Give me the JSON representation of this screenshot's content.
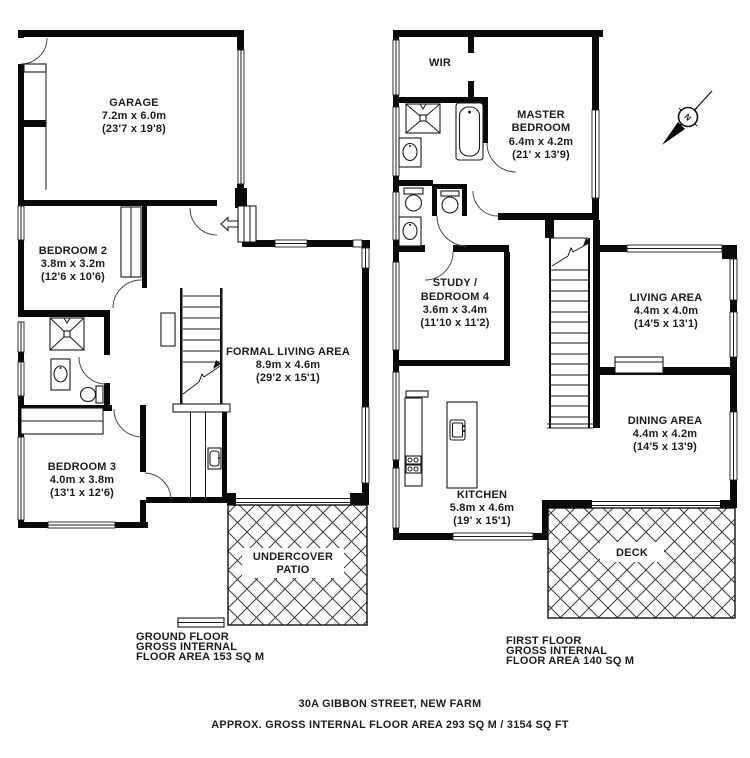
{
  "meta": {
    "address": "30A GIBBON STREET, NEW FARM",
    "area_summary": "APPROX. GROSS INTERNAL FLOOR AREA 293 SQ M / 3154 SQ FT"
  },
  "compass": {
    "north_label": "N"
  },
  "ground_floor": {
    "summary_lines": [
      "GROUND FLOOR",
      "GROSS INTERNAL",
      "FLOOR AREA 153 SQ M"
    ],
    "rooms": {
      "garage": {
        "lines": [
          "GARAGE",
          "7.2m x 6.0m",
          "(23'7 x 19'8)"
        ]
      },
      "bedroom2": {
        "lines": [
          "BEDROOM 2",
          "3.8m x 3.2m",
          "(12'6 x 10'6)"
        ]
      },
      "bedroom3": {
        "lines": [
          "BEDROOM 3",
          "4.0m x 3.8m",
          "(13'1 x 12'6)"
        ]
      },
      "formal_living": {
        "lines": [
          "FORMAL LIVING AREA",
          "8.9m x 4.6m",
          "(29'2 x 15'1)"
        ]
      },
      "patio": {
        "lines": [
          "UNDERCOVER",
          "PATIO"
        ]
      }
    }
  },
  "first_floor": {
    "summary_lines": [
      "FIRST FLOOR",
      "GROSS INTERNAL",
      "FLOOR AREA 140 SQ M"
    ],
    "rooms": {
      "wir": {
        "lines": [
          "WIR"
        ]
      },
      "master_bedroom": {
        "lines": [
          "MASTER",
          "BEDROOM",
          "6.4m x 4.2m",
          "(21' x 13'9)"
        ]
      },
      "study_bedroom4": {
        "lines": [
          "STUDY /",
          "BEDROOM 4",
          "3.6m x 3.4m",
          "(11'10 x 11'2)"
        ]
      },
      "living": {
        "lines": [
          "LIVING AREA",
          "4.4m x 4.0m",
          "(14'5 x 13'1)"
        ]
      },
      "dining": {
        "lines": [
          "DINING AREA",
          "4.4m x 4.2m",
          "(14'5 x 13'9)"
        ]
      },
      "kitchen": {
        "lines": [
          "KITCHEN",
          "5.8m x 4.6m",
          "(19' x 15'1)"
        ]
      },
      "deck": {
        "lines": [
          "DECK"
        ]
      }
    }
  }
}
